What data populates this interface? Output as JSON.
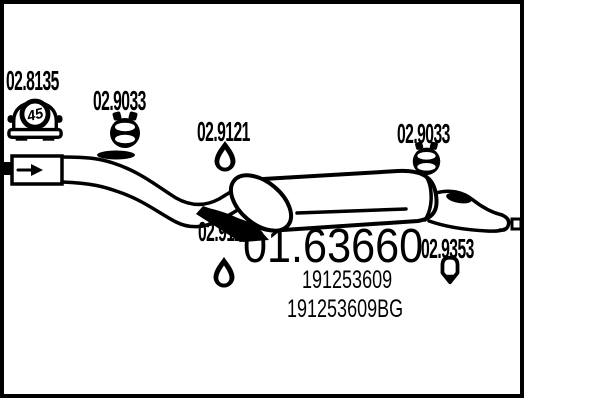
{
  "page": {
    "type": "exhaust-parts-diagram",
    "colors": {
      "ink": "#000000",
      "background": "#ffffff"
    }
  },
  "diagram": {
    "main_part": {
      "number": "01.63660"
    },
    "oem_numbers": {
      "line1": "191253609",
      "line2": "191253609BG"
    },
    "vehicle_badge": {
      "value": "45"
    },
    "parts": [
      {
        "number": "02.8135",
        "icon": "car-rear-badge"
      },
      {
        "number": "02.9033",
        "icon": "pipe-clamp"
      },
      {
        "number": "02.9121",
        "icon": "rubber-ring-hanger"
      },
      {
        "number": "02.9033",
        "icon": "pipe-clamp"
      },
      {
        "number": "02.9121",
        "icon": "rubber-ring-hanger"
      },
      {
        "number": "02.9353",
        "icon": "rubber-pin-hanger"
      }
    ]
  }
}
